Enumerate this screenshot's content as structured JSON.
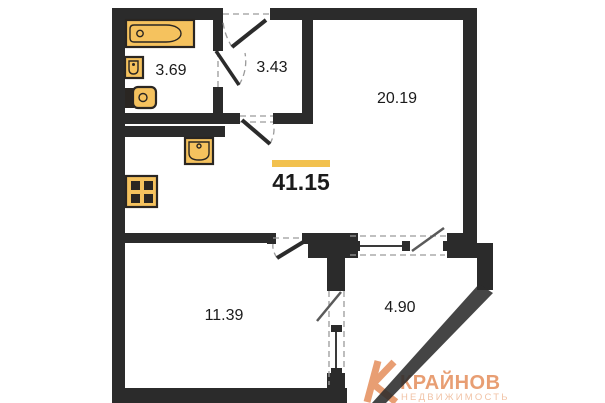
{
  "page": {
    "background": "#ffffff"
  },
  "floorplan": {
    "total_area": "41.15",
    "rooms": {
      "bathroom": "3.69",
      "hallway": "3.43",
      "living_room": "20.19",
      "bedroom": "11.39",
      "balcony": "4.90"
    },
    "colors": {
      "wall": "#2b2b2b",
      "fixture_fill": "#f5c25e",
      "fixture_stroke": "#2a2622",
      "area_accent_bar": "#f2c14e",
      "label_text": "#1b1b1b",
      "dash_guide": "#9a9a9a"
    },
    "icons": [
      "bathtub-icon",
      "bathroom-sink-icon",
      "toilet-icon",
      "kitchen-sink-icon",
      "stove-icon",
      "door-swing-icon",
      "window-icon"
    ]
  },
  "watermark": {
    "mark": "K-monogram",
    "brand": "КРАЙНОВ",
    "subtitle": "НЕДВИЖИМОСТЬ",
    "brand_color": "#e89e73",
    "subtitle_color": "#f1c3a6"
  }
}
